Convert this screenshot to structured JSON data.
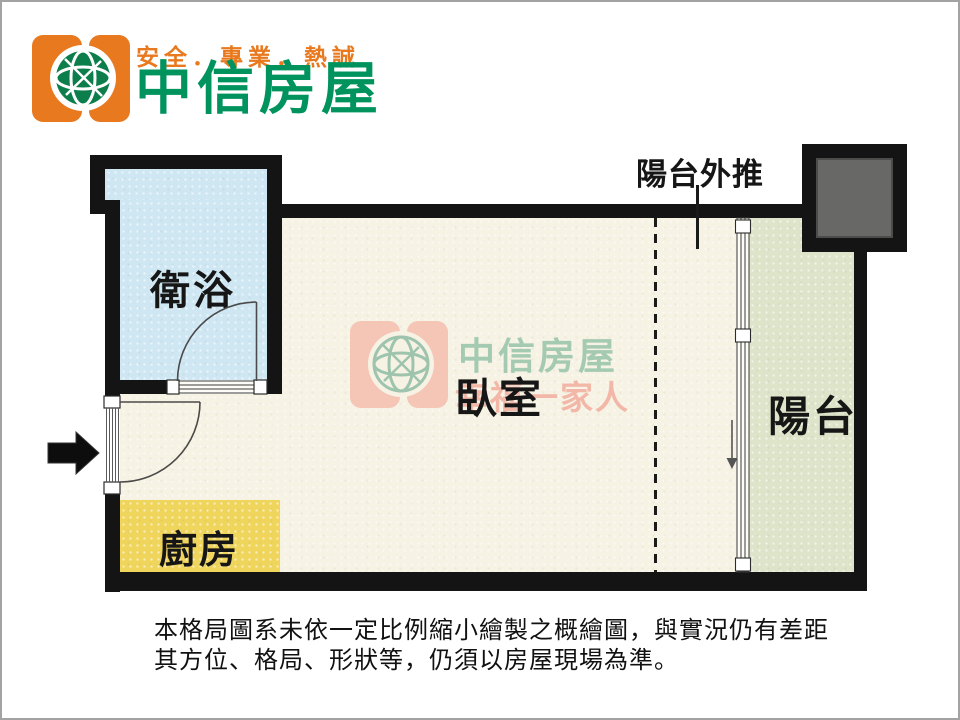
{
  "brand": {
    "tagline": "安全．專業．熱誠",
    "name": "中信房屋",
    "colors": {
      "orange": "#E8791E",
      "green": "#00935E"
    }
  },
  "plan": {
    "rooms": {
      "bathroom": {
        "label": "衛浴",
        "color": "#CFE7F3"
      },
      "bedroom": {
        "label": "臥室",
        "color": "#F6F2E4"
      },
      "kitchen": {
        "label": "廚房",
        "color": "#F0D55C"
      },
      "balcony": {
        "label": "陽台",
        "color": "#DDE4C9"
      }
    },
    "annotation_pushout": {
      "label": "陽台外推"
    },
    "watermark": {
      "line1": "中信房屋",
      "line2": "幸福一家人"
    },
    "wall_color": "#141414",
    "duct_color": "#686866"
  },
  "disclaimer": {
    "line1": "本格局圖系未依一定比例縮小繪製之概繪圖，與實況仍有差距",
    "line2": "其方位、格局、形狀等，仍須以房屋現場為準。"
  }
}
